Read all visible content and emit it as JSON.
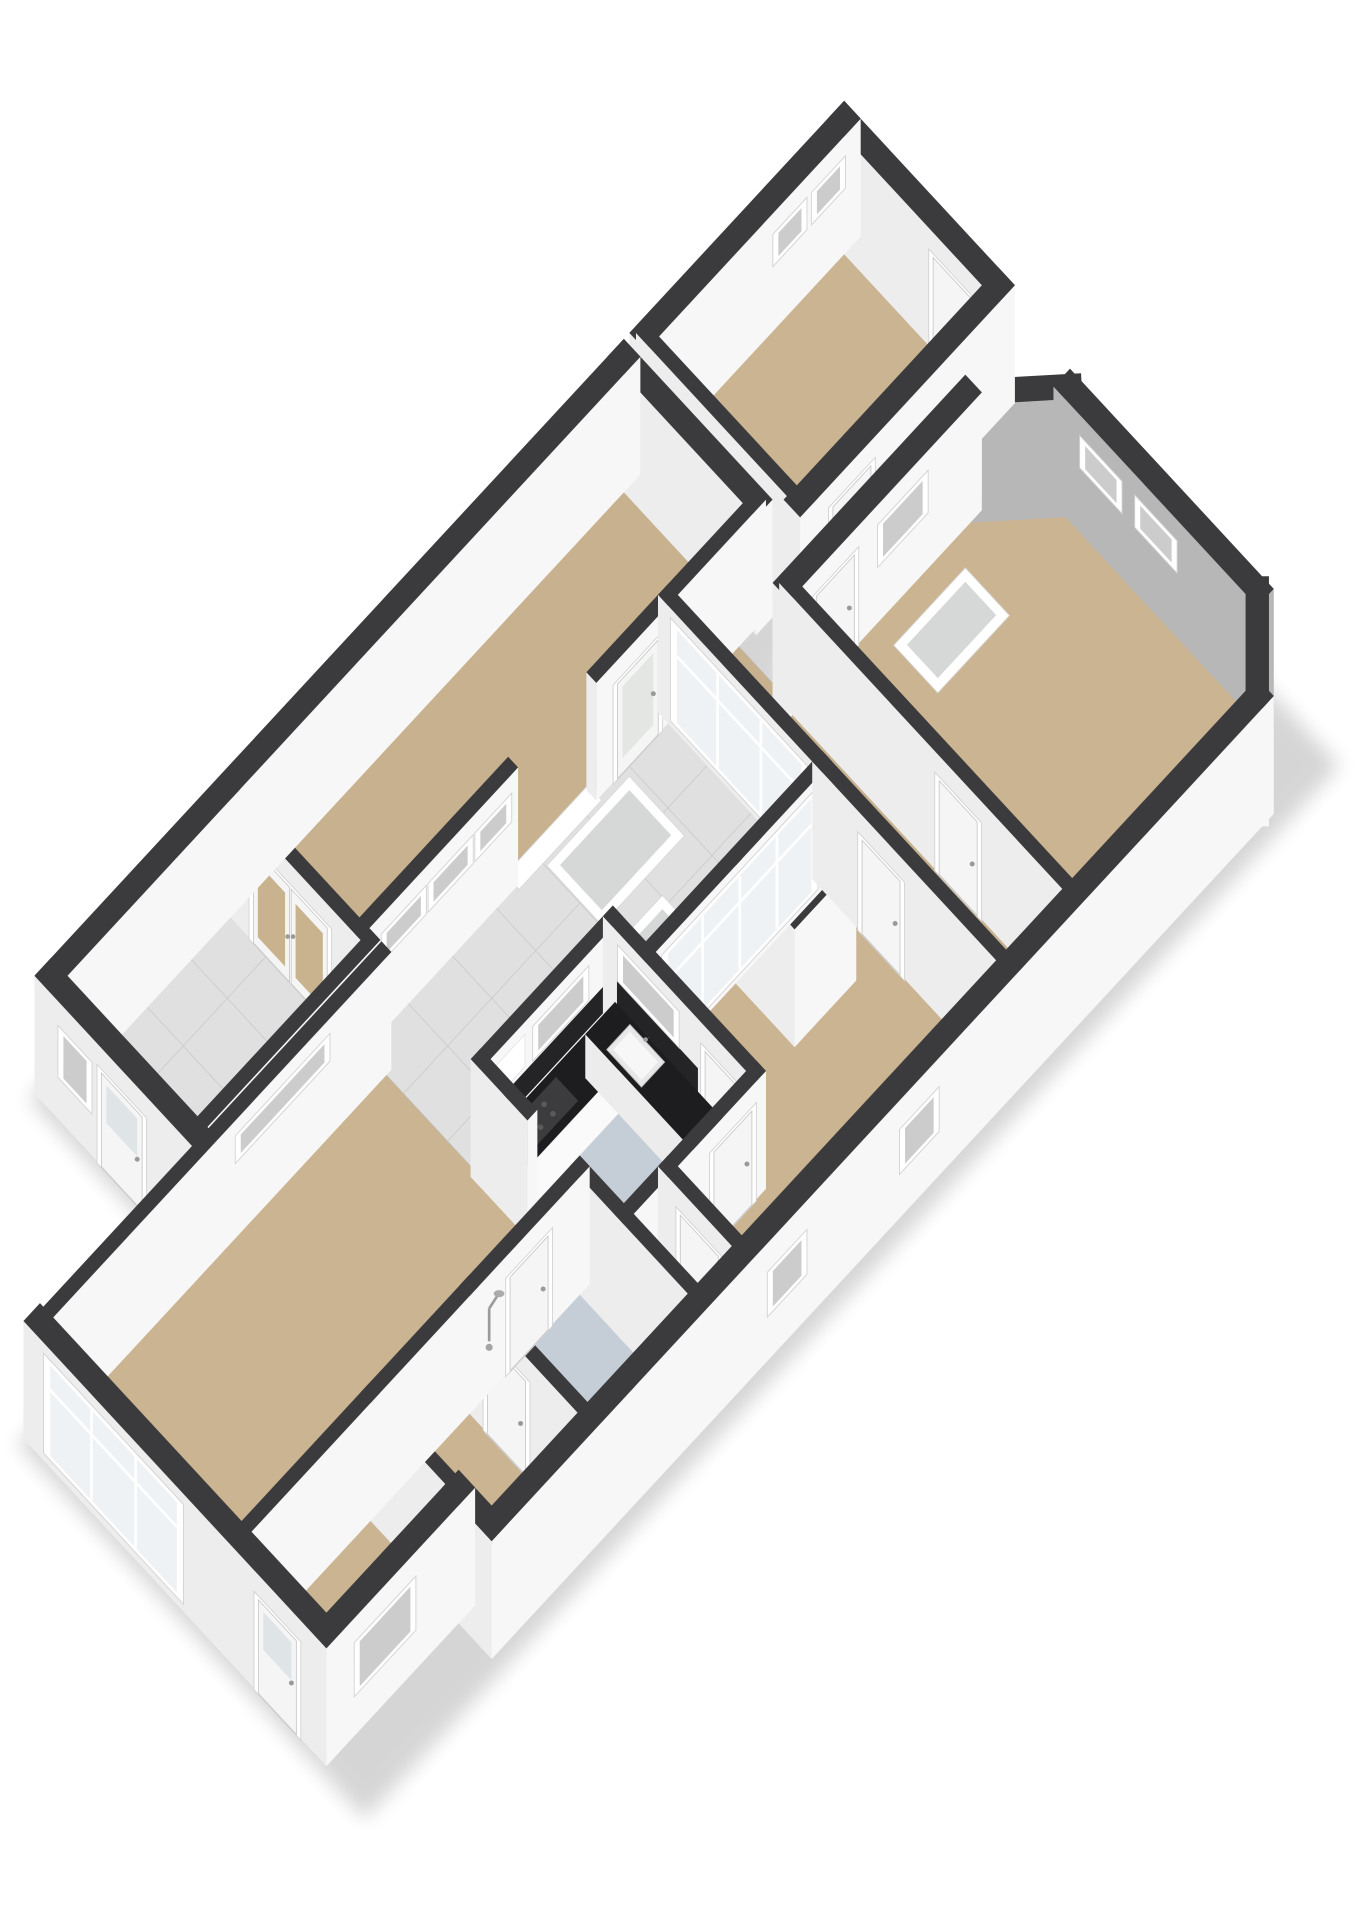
{
  "meta": {
    "title": "3D floor plan isometric render",
    "background": "#ffffff"
  },
  "projection": {
    "A": 62,
    "B": 67,
    "C": 52,
    "wallHeight": 2.55
  },
  "palette": {
    "cap": "#3b3b3d",
    "faceSE": "#f7f7f7",
    "faceSW": "#ededed",
    "faceNE": "#f0f0f0",
    "faceNW": "#f3f3f3",
    "accent": "#b7b7b7",
    "tan": "#cbb492",
    "tanDark": "#c8b18e",
    "tile": "#e0e0e0",
    "tileLine": "#cccccc",
    "blue": "#c5ced7",
    "wood": "#c69a60",
    "frame": "#ffffff",
    "frameStroke": "#d2d2d2",
    "glass": "#eff2f4",
    "glassTan": "#c9b28e",
    "glassGray": "#d6d8d8",
    "leaf": "#f5f5f5",
    "leafStroke": "#c9c9c9",
    "handle": "#9a9a9a",
    "counterTop": "#1d1d1f",
    "counterSide": "#fafafa",
    "backsplash": "#242426",
    "shadow": "#000000"
  },
  "shadows": [
    {
      "name": "shadow-west-wing",
      "pts": [
        [
          6.0,
          -0.2
        ],
        [
          20.8,
          -0.2
        ],
        [
          20.8,
          3.0
        ],
        [
          6.0,
          3.0
        ]
      ]
    },
    {
      "name": "shadow-main-block",
      "pts": [
        [
          3.0,
          2.6
        ],
        [
          16.4,
          2.6
        ],
        [
          16.4,
          8.9
        ],
        [
          3.0,
          8.9
        ]
      ]
    },
    {
      "name": "shadow-bedroom",
      "pts": [
        [
          16.0,
          3.2
        ],
        [
          20.7,
          3.2
        ],
        [
          20.7,
          8.9
        ],
        [
          16.0,
          8.9
        ]
      ]
    }
  ],
  "rooms": [
    {
      "name": "utility-room",
      "floor": "tile",
      "grid": true,
      "pts": [
        [
          6.2,
          0
        ],
        [
          9.4,
          0
        ],
        [
          9.4,
          2.6
        ],
        [
          6.2,
          2.6
        ]
      ]
    },
    {
      "name": "corridor",
      "floor": "tanDark",
      "pts": [
        [
          9.4,
          0
        ],
        [
          16.6,
          0
        ],
        [
          16.6,
          2.4
        ],
        [
          9.4,
          2.4
        ]
      ]
    },
    {
      "name": "top-room",
      "floor": "tan",
      "pts": [
        [
          17.0,
          0
        ],
        [
          20.6,
          0
        ],
        [
          20.6,
          2.8
        ],
        [
          17.0,
          2.8
        ]
      ]
    },
    {
      "name": "terrace",
      "floor": "tile",
      "grid": true,
      "pts": [
        [
          9.4,
          2.4
        ],
        [
          15.0,
          2.4
        ],
        [
          15.0,
          5.2
        ],
        [
          11.8,
          5.2
        ],
        [
          11.8,
          4.6
        ],
        [
          9.4,
          4.6
        ]
      ]
    },
    {
      "name": "living-room",
      "floor": "tan",
      "pts": [
        [
          3.2,
          2.8
        ],
        [
          9.4,
          2.8
        ],
        [
          9.4,
          6.4
        ],
        [
          5.6,
          6.4
        ],
        [
          5.6,
          8.0
        ],
        [
          3.2,
          8.0
        ]
      ]
    },
    {
      "name": "kitchen",
      "floor": "blue",
      "pts": [
        [
          9.4,
          4.6
        ],
        [
          11.8,
          4.6
        ],
        [
          11.8,
          7.2
        ],
        [
          9.4,
          7.2
        ]
      ]
    },
    {
      "name": "hall",
      "floor": "tan",
      "pts": [
        [
          11.8,
          5.2
        ],
        [
          15.0,
          5.2
        ],
        [
          15.0,
          8.6
        ],
        [
          10.2,
          8.6
        ],
        [
          10.2,
          7.2
        ],
        [
          11.8,
          7.2
        ]
      ]
    },
    {
      "name": "hallway-2",
      "floor": "tanDark",
      "pts": [
        [
          15.0,
          2.4
        ],
        [
          16.2,
          2.4
        ],
        [
          16.2,
          8.6
        ],
        [
          15.0,
          8.6
        ]
      ]
    },
    {
      "name": "bedroom-2",
      "floor": "tan",
      "pts": [
        [
          5.6,
          6.4
        ],
        [
          7.4,
          6.4
        ],
        [
          7.4,
          8.6
        ],
        [
          5.6,
          8.6
        ]
      ]
    },
    {
      "name": "bathroom",
      "floor": "blue",
      "pts": [
        [
          7.4,
          6.4
        ],
        [
          9.4,
          6.4
        ],
        [
          9.4,
          8.6
        ],
        [
          7.4,
          8.6
        ]
      ]
    },
    {
      "name": "wc",
      "floor": "blue",
      "pts": [
        [
          9.4,
          7.2
        ],
        [
          10.2,
          7.2
        ],
        [
          10.2,
          8.6
        ],
        [
          9.4,
          8.6
        ]
      ]
    },
    {
      "name": "bedroom-main",
      "floor": "tan",
      "pts": [
        [
          16.2,
          3.4
        ],
        [
          19.4,
          3.4
        ],
        [
          20.4,
          4.3
        ],
        [
          20.4,
          7.7
        ],
        [
          19.5,
          8.6
        ],
        [
          16.2,
          8.6
        ]
      ]
    },
    {
      "name": "boiler-closet",
      "floor": "wood",
      "pts": [
        [
          13.4,
          5.3
        ],
        [
          14.4,
          5.3
        ],
        [
          14.4,
          6.3
        ],
        [
          13.4,
          6.3
        ]
      ]
    }
  ],
  "panels": [
    {
      "name": "skylight-terrace-1",
      "r": [
        12.6,
        2.6,
        14.1,
        3.6
      ],
      "glass": "glassGray"
    },
    {
      "name": "skylight-terrace-2",
      "r": [
        12.0,
        3.9,
        13.4,
        4.9
      ],
      "glass": "glassGray"
    },
    {
      "name": "skylight-bedroom",
      "r": [
        17.6,
        3.9,
        18.9,
        4.7
      ],
      "glass": "glassGray"
    },
    {
      "name": "threshold-terrace",
      "r": [
        12.15,
        2.3,
        13.65,
        2.55
      ],
      "glass": null
    }
  ],
  "walls": [
    {
      "n": "wall-west-wing-nw",
      "a": [
        6.2,
        0
      ],
      "b": [
        16.6,
        0
      ],
      "t": 0.3
    },
    {
      "n": "wall-top-room-nw",
      "a": [
        17.0,
        0
      ],
      "b": [
        20.6,
        0
      ],
      "t": 0.3,
      "o": [
        {
          "k": "window",
          "r": [
            19.2,
            19.7
          ],
          "h": [
            1.5,
            2.08
          ]
        },
        {
          "k": "window",
          "r": [
            19.9,
            20.4
          ],
          "h": [
            1.5,
            2.08
          ]
        }
      ]
    },
    {
      "n": "wall-utility-sw",
      "a": [
        6.2,
        0
      ],
      "b": [
        6.2,
        2.6
      ],
      "t": 0.3,
      "o": [
        {
          "k": "window",
          "r": [
            0.35,
            0.85
          ],
          "h": [
            1.0,
            2.0
          ]
        },
        {
          "k": "door",
          "r": [
            1.05,
            1.85
          ],
          "h": [
            0,
            2.08
          ],
          "gl": true
        }
      ]
    },
    {
      "n": "wall-utility-se",
      "a": [
        6.2,
        2.6
      ],
      "b": [
        9.4,
        2.6
      ],
      "t": 0.18
    },
    {
      "n": "wall-french-doors",
      "a": [
        9.4,
        0
      ],
      "b": [
        9.4,
        2.6
      ],
      "t": 0.18,
      "o": [
        {
          "k": "doubledoor",
          "r": [
            0.55,
            1.95
          ],
          "h": [
            0,
            2.1
          ],
          "g": "glassTan"
        }
      ]
    },
    {
      "n": "wall-corridor-se-a",
      "a": [
        9.4,
        2.4
      ],
      "b": [
        12.1,
        2.4
      ],
      "t": 0.18,
      "o": [
        {
          "k": "window",
          "r": [
            9.75,
            10.45
          ],
          "h": [
            1.62,
            2.12
          ]
        },
        {
          "k": "window",
          "r": [
            10.6,
            11.3
          ],
          "h": [
            1.62,
            2.12
          ]
        },
        {
          "k": "window",
          "r": [
            11.45,
            12.0
          ],
          "h": [
            1.62,
            2.12
          ]
        }
      ]
    },
    {
      "n": "wall-corridor-se-b",
      "a": [
        13.7,
        2.4
      ],
      "b": [
        16.6,
        2.4
      ],
      "t": 0.18,
      "o": [
        {
          "k": "glassdoor",
          "r": [
            13.95,
            14.75
          ],
          "h": [
            0,
            2.1
          ]
        }
      ]
    },
    {
      "n": "wall-corridor-ne",
      "a": [
        16.6,
        0
      ],
      "b": [
        16.6,
        2.4
      ],
      "t": 0.3
    },
    {
      "n": "wall-top-room-sw",
      "a": [
        17.0,
        0
      ],
      "b": [
        17.0,
        2.8
      ],
      "t": 0.18,
      "o": [
        {
          "k": "window",
          "r": [
            0.95,
            1.7
          ],
          "h": [
            1.0,
            1.85
          ],
          "g": "glass"
        }
      ]
    },
    {
      "n": "wall-top-room-ne",
      "a": [
        20.6,
        0
      ],
      "b": [
        20.6,
        2.8
      ],
      "t": 0.3,
      "o": [
        {
          "k": "door",
          "r": [
            1.75,
            2.5
          ],
          "h": [
            0,
            2.08
          ]
        }
      ]
    },
    {
      "n": "wall-top-room-se",
      "a": [
        17.0,
        2.8
      ],
      "b": [
        20.6,
        2.8
      ],
      "t": 0.3,
      "o": [
        {
          "k": "door",
          "r": [
            17.4,
            18.15
          ],
          "h": [
            0,
            2.08
          ]
        }
      ]
    },
    {
      "n": "wall-living-nw",
      "a": [
        3.2,
        2.8
      ],
      "b": [
        9.4,
        2.8
      ],
      "t": 0.18,
      "o": [
        {
          "k": "window",
          "r": [
            6.7,
            8.3
          ],
          "h": [
            1.72,
            2.2
          ]
        }
      ]
    },
    {
      "n": "wall-living-sw",
      "a": [
        3.2,
        2.8
      ],
      "b": [
        3.2,
        8.0
      ],
      "t": 0.3,
      "o": [
        {
          "k": "bigwin",
          "r": [
            3.1,
            5.5
          ],
          "h": [
            0.25,
            2.3
          ],
          "m": 2,
          "tr": 1.72
        },
        {
          "k": "door",
          "r": [
            6.9,
            7.65
          ],
          "h": [
            0,
            2.08
          ],
          "gl": true
        }
      ]
    },
    {
      "n": "wall-ext-se",
      "a": [
        3.2,
        8.0
      ],
      "b": [
        5.6,
        8.0
      ],
      "t": 0.3,
      "o": [
        {
          "k": "window",
          "r": [
            3.6,
            4.6
          ],
          "h": [
            0.95,
            2.0
          ]
        }
      ]
    },
    {
      "n": "wall-step",
      "a": [
        5.6,
        8.0
      ],
      "b": [
        5.6,
        8.6
      ],
      "t": 0.3
    },
    {
      "n": "wall-main-se",
      "a": [
        5.6,
        8.6
      ],
      "b": [
        19.5,
        8.6
      ],
      "t": 0.3,
      "o": [
        {
          "k": "window",
          "r": [
            10.5,
            11.1
          ],
          "h": [
            1.05,
            1.9
          ]
        },
        {
          "k": "window",
          "r": [
            12.9,
            13.5
          ],
          "h": [
            1.05,
            1.9
          ]
        }
      ]
    },
    {
      "n": "wall-chamfer-e",
      "a": [
        19.5,
        8.6
      ],
      "b": [
        20.4,
        7.7
      ],
      "t": 0.3
    },
    {
      "n": "wall-bedroom-ne",
      "a": [
        20.4,
        4.3
      ],
      "b": [
        20.4,
        7.7
      ],
      "t": 0.3,
      "acc": true,
      "o": [
        {
          "k": "window",
          "r": [
            4.7,
            5.35
          ],
          "h": [
            1.5,
            2.08
          ]
        },
        {
          "k": "window",
          "r": [
            5.7,
            6.35
          ],
          "h": [
            1.5,
            2.08
          ]
        }
      ]
    },
    {
      "n": "wall-chamfer-n",
      "a": [
        19.4,
        3.4
      ],
      "b": [
        20.4,
        4.3
      ],
      "t": 0.3,
      "acc": true
    },
    {
      "n": "wall-bedroom-nw",
      "a": [
        16.2,
        3.4
      ],
      "b": [
        19.4,
        3.4
      ],
      "t": 0.3,
      "o": [
        {
          "k": "door",
          "r": [
            16.5,
            17.25
          ],
          "h": [
            0,
            2.08
          ]
        },
        {
          "k": "window",
          "r": [
            17.7,
            18.5
          ],
          "h": [
            1.3,
            2.1
          ]
        }
      ]
    },
    {
      "n": "wall-hallway2-div",
      "a": [
        16.2,
        3.4
      ],
      "b": [
        16.2,
        8.6
      ],
      "t": 0.18,
      "o": [
        {
          "k": "door",
          "r": [
            6.2,
            6.95
          ],
          "h": [
            0,
            2.08
          ]
        }
      ]
    },
    {
      "n": "wall-lobby-glass",
      "a": [
        15.0,
        2.4
      ],
      "b": [
        15.0,
        5.2
      ],
      "t": 0.18,
      "o": [
        {
          "k": "bigwin",
          "r": [
            2.62,
            4.98
          ],
          "h": [
            0.2,
            2.32
          ],
          "m": 2,
          "tr": 1.7
        }
      ]
    },
    {
      "n": "wall-hall-glass",
      "a": [
        11.8,
        5.2
      ],
      "b": [
        15.0,
        5.2
      ],
      "t": 0.18,
      "o": [
        {
          "k": "bigwin",
          "r": [
            12.05,
            14.75
          ],
          "h": [
            0.2,
            2.32
          ],
          "m": 3,
          "tr": 1.7
        }
      ]
    },
    {
      "n": "wall-kitchen-ne",
      "a": [
        11.8,
        4.6
      ],
      "b": [
        11.8,
        7.2
      ],
      "t": 0.18,
      "o": [
        {
          "k": "deco",
          "r": [
            4.78,
            6.25
          ],
          "h": [
            0.95,
            1.52
          ],
          "g": "backsplash"
        },
        {
          "k": "window",
          "r": [
            4.85,
            5.85
          ],
          "h": [
            1.58,
            2.25
          ]
        },
        {
          "k": "door",
          "r": [
            6.35,
            7.1
          ],
          "h": [
            0,
            2.08
          ]
        }
      ]
    },
    {
      "n": "wall-kitchen-nw",
      "a": [
        9.4,
        4.6
      ],
      "b": [
        11.8,
        4.6
      ],
      "t": 0.18,
      "o": [
        {
          "k": "deco",
          "r": [
            9.6,
            11.7
          ],
          "h": [
            0.95,
            1.52
          ],
          "g": "backsplash"
        },
        {
          "k": "deco",
          "r": [
            9.55,
            10.1
          ],
          "h": [
            1.62,
            2.32
          ],
          "g": "frame"
        },
        {
          "k": "window",
          "r": [
            10.3,
            11.2
          ],
          "h": [
            1.62,
            2.25
          ]
        }
      ]
    },
    {
      "n": "wall-kitchen-stub",
      "a": [
        9.4,
        4.6
      ],
      "b": [
        9.4,
        5.45
      ],
      "t": 0.18
    },
    {
      "n": "wall-kitchen-se",
      "a": [
        9.4,
        7.2
      ],
      "b": [
        11.8,
        7.2
      ],
      "t": 0.18,
      "o": [
        {
          "k": "door",
          "r": [
            10.9,
            11.65
          ],
          "h": [
            0,
            2.08
          ]
        }
      ]
    },
    {
      "n": "wall-living-se",
      "a": [
        3.2,
        6.4
      ],
      "b": [
        9.4,
        6.4
      ],
      "t": 0.18,
      "o": [
        {
          "k": "door",
          "r": [
            8.0,
            8.75
          ],
          "h": [
            0,
            2.08
          ]
        },
        {
          "k": "shower",
          "r": [
            7.5,
            7.8
          ],
          "h": [
            1.0,
            2.0
          ]
        }
      ]
    },
    {
      "n": "wall-bedroom2-div",
      "a": [
        5.6,
        6.4
      ],
      "b": [
        5.6,
        8.0
      ],
      "t": 0.18
    },
    {
      "n": "wall-bath-div",
      "a": [
        7.4,
        6.4
      ],
      "b": [
        7.4,
        8.6
      ],
      "t": 0.18,
      "o": [
        {
          "k": "door",
          "r": [
            6.8,
            7.55
          ],
          "h": [
            0,
            2.08
          ]
        }
      ]
    },
    {
      "n": "wall-bath-ne",
      "a": [
        9.4,
        6.4
      ],
      "b": [
        9.4,
        8.6
      ],
      "t": 0.18
    },
    {
      "n": "wall-vest-div",
      "a": [
        10.2,
        7.2
      ],
      "b": [
        10.2,
        8.6
      ],
      "t": 0.18,
      "o": [
        {
          "k": "door",
          "r": [
            7.5,
            8.25
          ],
          "h": [
            0,
            2.08
          ]
        }
      ]
    },
    {
      "n": "wall-hall-div",
      "a": [
        15.0,
        5.2
      ],
      "b": [
        15.0,
        8.6
      ],
      "t": 0.18,
      "o": [
        {
          "k": "door",
          "r": [
            6.0,
            6.75
          ],
          "h": [
            0,
            2.08
          ]
        }
      ]
    },
    {
      "n": "wall-closet-a",
      "a": [
        13.4,
        5.3
      ],
      "b": [
        13.4,
        6.3
      ],
      "t": 0.12
    },
    {
      "n": "wall-closet-b",
      "a": [
        13.4,
        6.3
      ],
      "b": [
        14.4,
        6.3
      ],
      "t": 0.12
    }
  ],
  "boxes": [
    {
      "name": "kitchen-counter-nw",
      "r": [
        9.55,
        4.72,
        11.72,
        5.32
      ],
      "h": 0.95,
      "top": "counterTop",
      "side": "counterSide",
      "decals": [
        {
          "kind": "hob",
          "r": [
            9.8,
            4.82,
            10.55,
            5.22
          ]
        }
      ]
    },
    {
      "name": "kitchen-counter-ne",
      "r": [
        11.18,
        4.72,
        11.72,
        7.0
      ],
      "h": 0.95,
      "top": "counterTop",
      "side": "counterSide",
      "decals": [
        {
          "kind": "sink",
          "r": [
            11.24,
            5.05,
            11.66,
            5.68
          ]
        }
      ]
    },
    {
      "name": "boiler-unit",
      "r": [
        13.55,
        5.38,
        14.25,
        5.98
      ],
      "h": 1.08,
      "top": "frame",
      "side": "counterSide",
      "decals": []
    }
  ]
}
